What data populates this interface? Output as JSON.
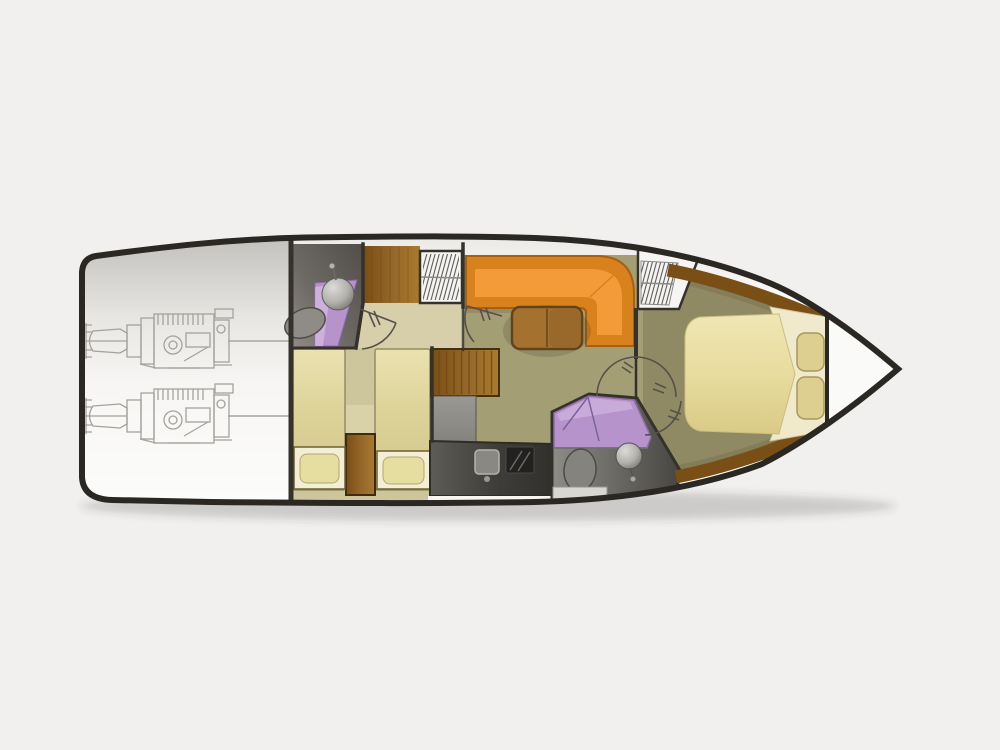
{
  "diagram": {
    "type": "yacht-lower-deck-floorplan",
    "orientation": "bow-right-stern-left",
    "rooms": [
      {
        "id": "engine-room",
        "features": [
          "port-engine-drawing",
          "starboard-engine-drawing",
          "prop-shaft-lines"
        ]
      },
      {
        "id": "aft-bathroom",
        "features": [
          "washbasin",
          "toilet",
          "purple-vanity",
          "door-swing"
        ]
      },
      {
        "id": "twin-berth-cabin",
        "features": [
          "port-berth",
          "starboard-berth",
          "pillow-lockers",
          "wood-cabinet"
        ]
      },
      {
        "id": "corridor",
        "features": [
          "door-swing-aft-bathroom",
          "door-swing-saloon"
        ]
      },
      {
        "id": "saloon",
        "features": [
          "l-shaped-sofa",
          "wood-table",
          "wood-steps-chest",
          "hatch-grille-aft",
          "hatch-grille-forward"
        ]
      },
      {
        "id": "galley",
        "features": [
          "counter",
          "sink",
          "cooktop"
        ]
      },
      {
        "id": "shower-room",
        "features": [
          "purple-shower",
          "toilet",
          "washbasin",
          "shower-door-lines"
        ]
      },
      {
        "id": "master-cabin",
        "features": [
          "double-berth",
          "two-pillows",
          "bed-platform",
          "wood-trim",
          "double-door-swings"
        ]
      },
      {
        "id": "bow-locker",
        "features": []
      }
    ]
  },
  "colors": {
    "page_bg": "#f1f0ee",
    "hull_outline": "#2b2824",
    "hull_fill": "#fafaf8",
    "engine_line": "#a5a29d",
    "wall_line": "#35312b",
    "door_arc": "#55504a",
    "shower_purple": "#b793cb",
    "shower_purple_light": "#d4bae2",
    "shower_purple_edge": "#8e6aab",
    "fixture_gray": "#8f8c87",
    "fixture_outline": "#504c47",
    "corridor_floor": "#d6cfa9",
    "cabin_floor": "#cdc69d",
    "berth_outline": "#948d60",
    "pillow_box": "#f3efd6",
    "pillow": "#e6dda0",
    "pillow_edge": "#b3a86f",
    "box_edge": "#6f5e30",
    "salon_floor": "#a49e75",
    "master_floor": "#8f8a63",
    "master_trim": "#7a4f16",
    "sofa_back": "#d7821c",
    "sofa_seat": "#f29b38",
    "sofa_outline": "#a95f10",
    "table_wood": "#a4722e",
    "table_outline": "#63441a",
    "sink": "#8a8882",
    "sink_edge": "#b5b3ad",
    "cooktop": "#232120",
    "grille_bg": "#f6f5f3",
    "hatch_line": "#5a5a56",
    "bed_platform": "#f0e9cb",
    "bed_pillow": "#dccf8f",
    "bed_pillow_outline": "#a6995c",
    "mattress_edge": "#cbbd82",
    "counter_edge": "#2e2c29",
    "wood_dark": "#7a4e14",
    "wood_light": "#aa7a2c",
    "shadow": "rgba(60,58,52,0.20)",
    "white_deck": "#f6f5f2",
    "tray": "#d9d7d2"
  }
}
